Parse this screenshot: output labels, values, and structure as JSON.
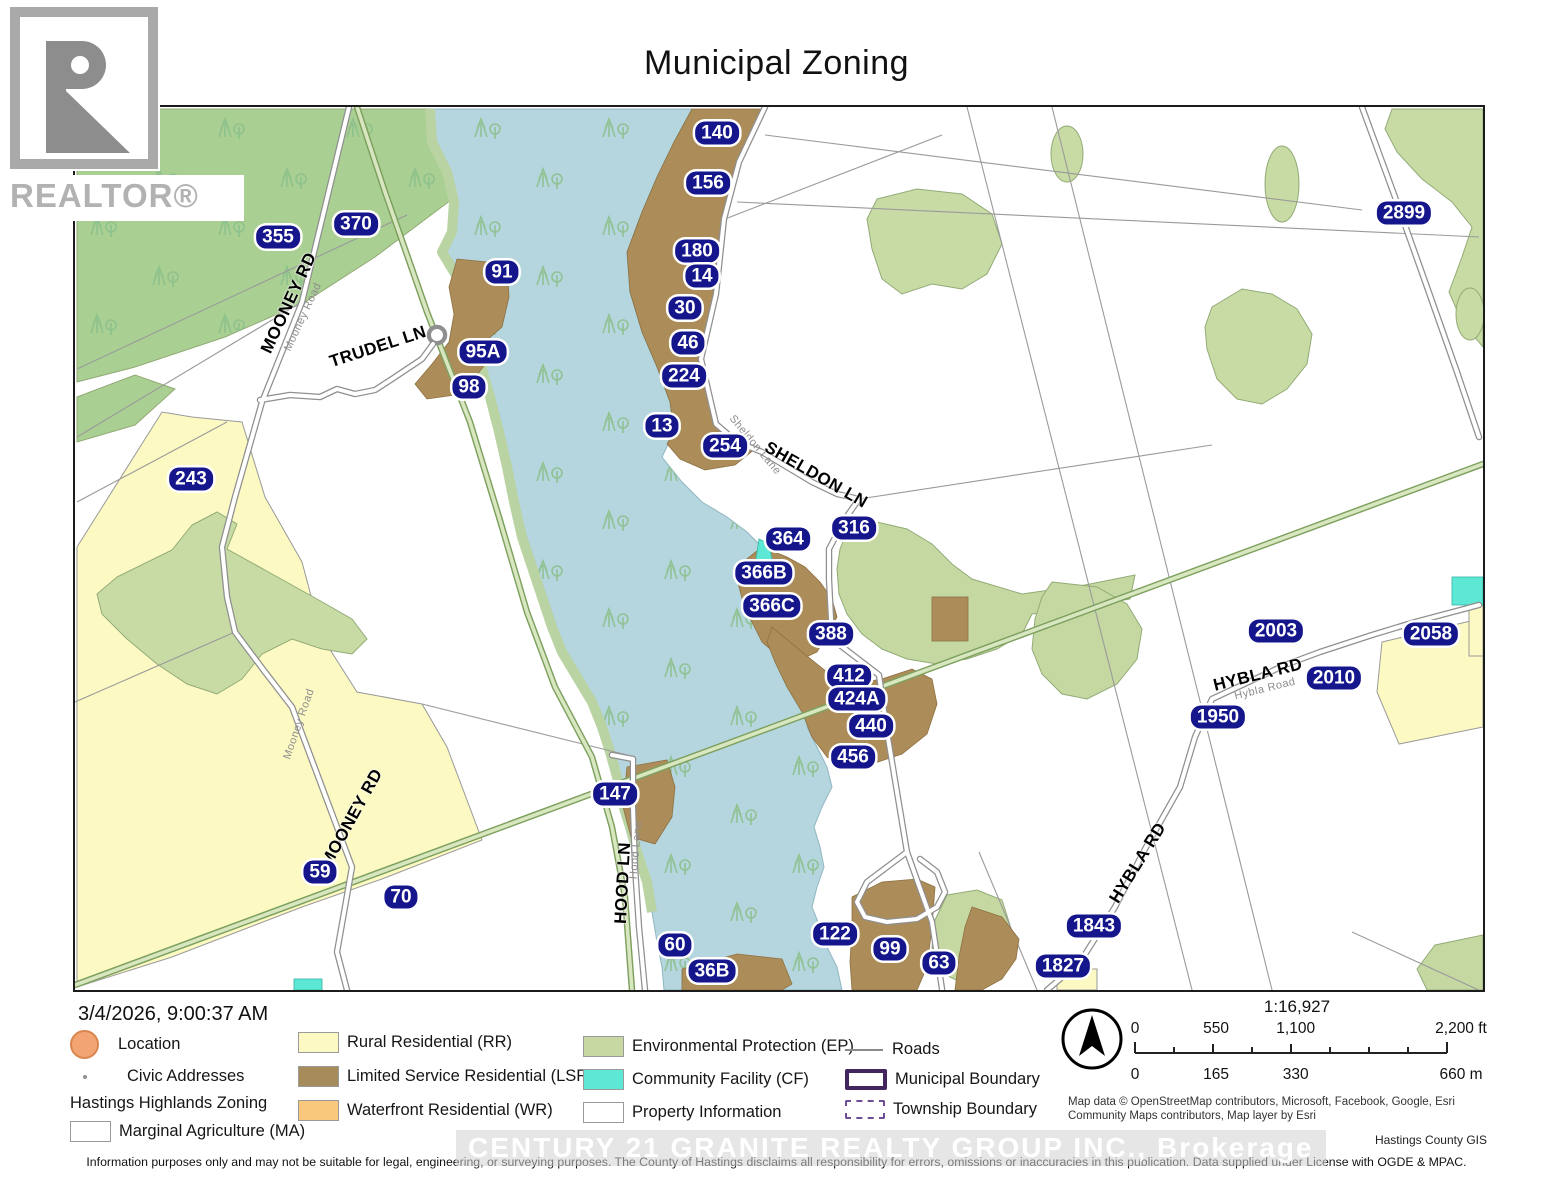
{
  "title": "Municipal Zoning",
  "branding": {
    "realtor_logo_text": "REALTOR®",
    "watermark": "CENTURY 21 GRANITE REALTY GROUP INC., Brokerage"
  },
  "timestamp": "3/4/2026, 9:00:37 AM",
  "credit": "Hastings County GIS",
  "attribution": "Map data © OpenStreetMap contributors, Microsoft, Facebook, Google, Esri Community Maps contributors, Map layer by Esri",
  "disclaimer": "Information purposes only and may not be suitable for legal, engineering, or surveying purposes.  The County of Hastings disclaims all responsibility for errors, omissions or inaccuracies in this publication. Data supplied under License with OGDE & MPAC.",
  "scale": {
    "ratio": "1:16,927",
    "ft_labels": [
      "0",
      "550",
      "1,100",
      "2,200 ft"
    ],
    "m_labels": [
      "0",
      "165",
      "330",
      "660 m"
    ]
  },
  "colors": {
    "badge": "#15158c",
    "location_fill": "#f2a573",
    "location_border": "#d9854f",
    "rural_residential": "#fcf9c3",
    "limited_service_residential": "#a78c5b",
    "waterfront_residential": "#f9c87d",
    "environmental_protection": "#c7d8a3",
    "community_facility": "#5ce8d4",
    "white_zone": "#ffffff",
    "municipal_boundary": "#44265e",
    "township_boundary": "#6d4d97",
    "lake": "#b5d6de"
  },
  "legend": {
    "col1": [
      {
        "type": "circle",
        "label": "Location"
      },
      {
        "type": "dot",
        "label": "Civic Addresses"
      },
      {
        "type": "heading",
        "label": "Hastings Highlands Zoning"
      },
      {
        "type": "swatch",
        "color": "#ffffff",
        "label": "Marginal Agriculture (MA)"
      }
    ],
    "col2": [
      {
        "type": "swatch",
        "color": "#fcf9c3",
        "label": "Rural Residential (RR)"
      },
      {
        "type": "swatch",
        "color": "#a78c5b",
        "label": "Limited Service Residential (LSR)"
      },
      {
        "type": "swatch",
        "color": "#f9c87d",
        "label": "Waterfront Residential (WR)"
      }
    ],
    "col3": [
      {
        "type": "swatch",
        "color": "#c7d8a3",
        "label": "Environmental Protection (EP)"
      },
      {
        "type": "swatch",
        "color": "#5ce8d4",
        "label": "Community Facility (CF)"
      },
      {
        "type": "swatch",
        "color": "#ffffff",
        "label": "Property Information"
      }
    ],
    "col4": [
      {
        "type": "line",
        "label": "Roads"
      },
      {
        "type": "rect",
        "label": "Municipal Boundary"
      },
      {
        "type": "dashed",
        "label": "Township Boundary"
      }
    ]
  },
  "map": {
    "address_badges": [
      {
        "label": "140",
        "x": 642,
        "y": 26
      },
      {
        "label": "156",
        "x": 633,
        "y": 76
      },
      {
        "label": "180",
        "x": 622,
        "y": 144
      },
      {
        "label": "14",
        "x": 627,
        "y": 169
      },
      {
        "label": "30",
        "x": 610,
        "y": 201
      },
      {
        "label": "46",
        "x": 613,
        "y": 236
      },
      {
        "label": "224",
        "x": 609,
        "y": 269
      },
      {
        "label": "13",
        "x": 587,
        "y": 319
      },
      {
        "label": "254",
        "x": 650,
        "y": 339
      },
      {
        "label": "316",
        "x": 779,
        "y": 421
      },
      {
        "label": "364",
        "x": 713,
        "y": 432
      },
      {
        "label": "366B",
        "x": 689,
        "y": 466
      },
      {
        "label": "366C",
        "x": 697,
        "y": 499
      },
      {
        "label": "388",
        "x": 756,
        "y": 527
      },
      {
        "label": "412",
        "x": 774,
        "y": 569
      },
      {
        "label": "424A",
        "x": 782,
        "y": 592
      },
      {
        "label": "440",
        "x": 796,
        "y": 619
      },
      {
        "label": "456",
        "x": 778,
        "y": 650
      },
      {
        "label": "91",
        "x": 427,
        "y": 165
      },
      {
        "label": "95A",
        "x": 408,
        "y": 245
      },
      {
        "label": "98",
        "x": 394,
        "y": 280
      },
      {
        "label": "355",
        "x": 203,
        "y": 130
      },
      {
        "label": "370",
        "x": 281,
        "y": 117
      },
      {
        "label": "243",
        "x": 116,
        "y": 372
      },
      {
        "label": "59",
        "x": 245,
        "y": 765
      },
      {
        "label": "70",
        "x": 326,
        "y": 790
      },
      {
        "label": "147",
        "x": 540,
        "y": 687
      },
      {
        "label": "60",
        "x": 600,
        "y": 838
      },
      {
        "label": "36B",
        "x": 637,
        "y": 864
      },
      {
        "label": "122",
        "x": 760,
        "y": 827
      },
      {
        "label": "99",
        "x": 815,
        "y": 842
      },
      {
        "label": "63",
        "x": 864,
        "y": 856
      },
      {
        "label": "1843",
        "x": 1019,
        "y": 819
      },
      {
        "label": "1827",
        "x": 988,
        "y": 859
      },
      {
        "label": "1950",
        "x": 1143,
        "y": 610
      },
      {
        "label": "2010",
        "x": 1259,
        "y": 571
      },
      {
        "label": "2003",
        "x": 1201,
        "y": 524
      },
      {
        "label": "2058",
        "x": 1356,
        "y": 527
      },
      {
        "label": "2899",
        "x": 1329,
        "y": 106
      }
    ],
    "road_labels": [
      {
        "text": "MOONEY RD",
        "x": 214,
        "y": 196,
        "rot": -65,
        "kind": "main"
      },
      {
        "text": "Mooney Road",
        "x": 228,
        "y": 210,
        "rot": -65,
        "kind": "sub"
      },
      {
        "text": "TRUDEL LN",
        "x": 303,
        "y": 240,
        "rot": -18,
        "kind": "main"
      },
      {
        "text": "MOONEY RD",
        "x": 277,
        "y": 711,
        "rot": -61,
        "kind": "main"
      },
      {
        "text": "Mooney Road",
        "x": 224,
        "y": 617,
        "rot": -71,
        "kind": "sub"
      },
      {
        "text": "SHELDON LN",
        "x": 741,
        "y": 368,
        "rot": 30,
        "kind": "main"
      },
      {
        "text": "Sheldon Lane",
        "x": 680,
        "y": 338,
        "rot": 50,
        "kind": "sub"
      },
      {
        "text": "HOOD LN",
        "x": 548,
        "y": 776,
        "rot": -87,
        "kind": "main"
      },
      {
        "text": "Hood Lane",
        "x": 561,
        "y": 743,
        "rot": -85,
        "kind": "sub"
      },
      {
        "text": "HYBLA RD",
        "x": 1183,
        "y": 568,
        "rot": -14,
        "kind": "main"
      },
      {
        "text": "Hybla Road",
        "x": 1190,
        "y": 582,
        "rot": -14,
        "kind": "sub"
      },
      {
        "text": "HYBLA RD",
        "x": 1063,
        "y": 756,
        "rot": -58,
        "kind": "main"
      }
    ]
  }
}
